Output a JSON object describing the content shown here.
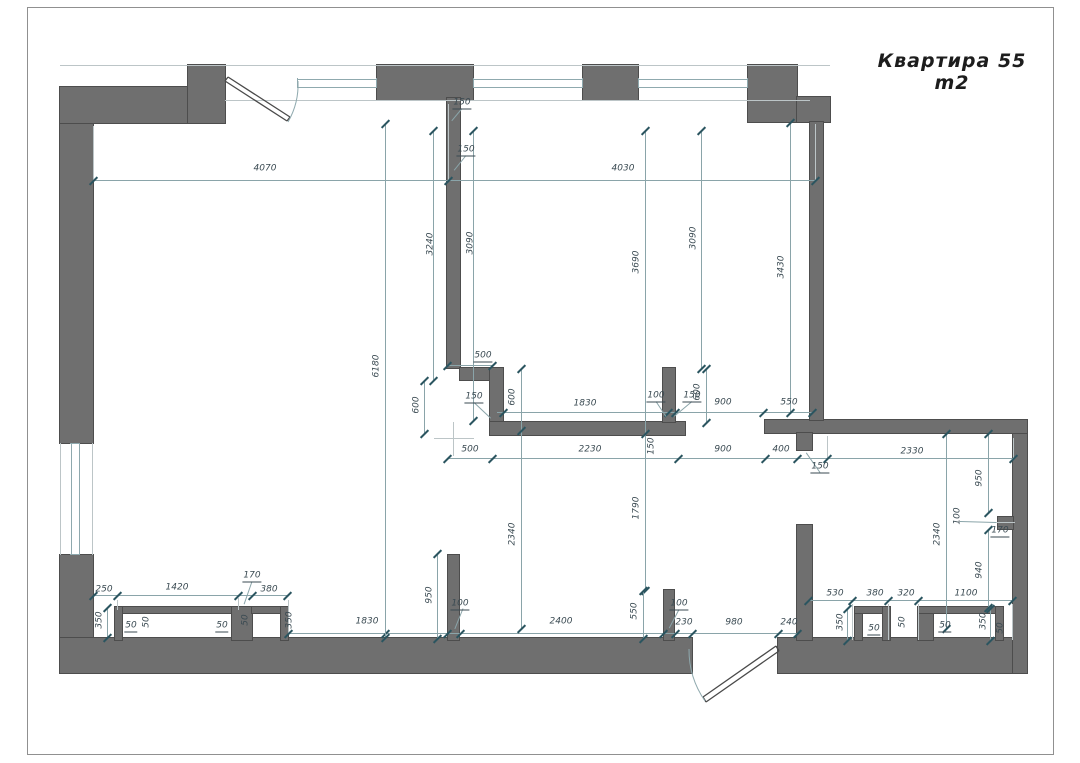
{
  "sheet": {
    "title": "Квартира 55 m2"
  },
  "colors": {
    "wall": "#6f6f6f",
    "walledge": "#4d4d4d",
    "dim": "#8aa4a9",
    "tick": "#2b5560",
    "txt": "#3a4a52",
    "thin": "#bcc5c7",
    "winline": "#8fa9ae",
    "frame": "#909090",
    "door": "#4a4a4a"
  },
  "floorplan": {
    "walls": [
      [
        60,
        87,
        33,
        356
      ],
      [
        60,
        555,
        33,
        85
      ],
      [
        60,
        638,
        632,
        35
      ],
      [
        778,
        638,
        249,
        35
      ],
      [
        1013,
        422,
        14,
        251
      ],
      [
        765,
        420,
        262,
        13
      ],
      [
        60,
        87,
        165,
        36
      ],
      [
        188,
        65,
        37,
        58
      ],
      [
        377,
        65,
        96,
        35
      ],
      [
        583,
        65,
        55,
        35
      ],
      [
        748,
        65,
        49,
        57
      ],
      [
        797,
        97,
        33,
        25
      ],
      [
        810,
        122,
        13,
        298
      ],
      [
        447,
        98,
        13,
        270
      ],
      [
        460,
        368,
        30,
        12
      ],
      [
        490,
        368,
        13,
        54
      ],
      [
        490,
        422,
        195,
        13
      ],
      [
        663,
        368,
        12,
        54
      ],
      [
        797,
        433,
        15,
        17
      ],
      [
        797,
        525,
        15,
        115
      ],
      [
        448,
        555,
        11,
        85
      ],
      [
        664,
        590,
        10,
        50
      ],
      [
        998,
        517,
        15,
        12
      ],
      [
        115,
        607,
        123,
        6
      ],
      [
        115,
        607,
        7,
        33
      ],
      [
        232,
        607,
        20,
        33
      ],
      [
        252,
        607,
        36,
        6
      ],
      [
        281,
        607,
        7,
        33
      ],
      [
        855,
        607,
        7,
        33
      ],
      [
        855,
        607,
        35,
        6
      ],
      [
        883,
        607,
        7,
        33
      ],
      [
        918,
        607,
        15,
        33
      ],
      [
        918,
        607,
        85,
        6
      ],
      [
        996,
        607,
        7,
        33
      ]
    ],
    "windows": [
      {
        "o": "h",
        "x": 297,
        "y": 79,
        "l": 80
      },
      {
        "o": "h",
        "x": 473,
        "y": 79,
        "l": 110
      },
      {
        "o": "h",
        "x": 638,
        "y": 79,
        "l": 110
      },
      {
        "o": "v",
        "x": 71,
        "y": 443,
        "l": 112
      }
    ],
    "thin": [
      [
        "h",
        60,
        65,
        770
      ],
      [
        "h",
        225,
        100,
        585
      ],
      [
        "h",
        434,
        438,
        40
      ],
      [
        "v",
        453,
        422,
        34
      ],
      [
        "v",
        60,
        443,
        112
      ],
      [
        "v",
        92,
        443,
        112
      ]
    ],
    "ext": [
      [
        "v",
        93,
        126,
        56
      ],
      [
        "v",
        448,
        104,
        78
      ],
      [
        "v",
        815,
        124,
        58
      ],
      [
        "v",
        827,
        436,
        24
      ],
      [
        "v",
        1013,
        438,
        22
      ],
      [
        "v",
        288,
        600,
        35
      ],
      [
        "v",
        117,
        600,
        10
      ],
      [
        "v",
        238,
        598,
        12
      ],
      [
        "v",
        852,
        604,
        36
      ],
      [
        "v",
        888,
        604,
        36
      ],
      [
        "v",
        918,
        604,
        36
      ],
      [
        "v",
        1012,
        604,
        36
      ],
      [
        "h",
        995,
        522,
        20
      ]
    ],
    "dim_lines": [
      {
        "o": "h",
        "x": 93,
        "y": 180,
        "l": 722,
        "t": [
          0,
          355,
          722
        ]
      },
      {
        "o": "h",
        "x": 447,
        "y": 365,
        "l": 45,
        "t": [
          0,
          45
        ]
      },
      {
        "o": "h",
        "x": 497,
        "y": 412,
        "l": 315,
        "t": [
          6,
          171,
          178,
          266,
          315
        ]
      },
      {
        "o": "h",
        "x": 447,
        "y": 458,
        "l": 566,
        "t": [
          0,
          45,
          231,
          318,
          350,
          380,
          566
        ]
      },
      {
        "o": "h",
        "x": 93,
        "y": 595,
        "l": 195,
        "t": [
          0,
          24,
          145,
          159,
          194
        ]
      },
      {
        "o": "h",
        "x": 808,
        "y": 600,
        "l": 204,
        "t": [
          0,
          44,
          80,
          110,
          204
        ]
      },
      {
        "o": "h",
        "x": 288,
        "y": 633,
        "l": 509,
        "t": [
          0,
          97,
          159,
          172,
          375,
          387,
          404,
          490,
          509
        ]
      },
      {
        "o": "v",
        "x": 385,
        "y": 123,
        "l": 514,
        "t": [
          0,
          514
        ]
      },
      {
        "o": "v",
        "x": 433,
        "y": 130,
        "l": 250,
        "t": [
          0,
          250
        ]
      },
      {
        "o": "v",
        "x": 473,
        "y": 130,
        "l": 290,
        "t": [
          0,
          290
        ]
      },
      {
        "o": "v",
        "x": 645,
        "y": 130,
        "l": 460,
        "t": [
          0,
          303,
          460
        ]
      },
      {
        "o": "v",
        "x": 701,
        "y": 130,
        "l": 238,
        "t": [
          0,
          238
        ]
      },
      {
        "o": "v",
        "x": 790,
        "y": 122,
        "l": 290,
        "t": [
          0,
          290
        ]
      },
      {
        "o": "v",
        "x": 424,
        "y": 380,
        "l": 53,
        "t": [
          0,
          53
        ]
      },
      {
        "o": "v",
        "x": 521,
        "y": 368,
        "l": 260,
        "t": [
          0,
          62,
          260
        ]
      },
      {
        "o": "v",
        "x": 706,
        "y": 368,
        "l": 54,
        "t": [
          0,
          54
        ]
      },
      {
        "o": "v",
        "x": 946,
        "y": 433,
        "l": 195,
        "t": [
          0,
          195
        ]
      },
      {
        "o": "v",
        "x": 988,
        "y": 433,
        "l": 79,
        "t": [
          0,
          79
        ]
      },
      {
        "o": "v",
        "x": 988,
        "y": 529,
        "l": 78,
        "t": [
          0,
          78
        ]
      },
      {
        "o": "v",
        "x": 437,
        "y": 553,
        "l": 85,
        "t": [
          0,
          85
        ]
      },
      {
        "o": "v",
        "x": 643,
        "y": 590,
        "l": 48,
        "t": [
          0,
          48
        ]
      },
      {
        "o": "v",
        "x": 107,
        "y": 607,
        "l": 30,
        "t": [
          0,
          30
        ]
      },
      {
        "o": "v",
        "x": 847,
        "y": 608,
        "l": 32,
        "t": [
          0,
          32
        ]
      },
      {
        "o": "v",
        "x": 990,
        "y": 608,
        "l": 32,
        "t": [
          0,
          32
        ]
      }
    ],
    "leaders": [
      [
        462,
        108,
        452,
        120
      ],
      [
        466,
        155,
        454,
        170
      ],
      [
        474,
        402,
        491,
        418
      ],
      [
        656,
        401,
        666,
        416
      ],
      [
        692,
        401,
        674,
        416
      ],
      [
        820,
        472,
        806,
        452
      ],
      [
        252,
        581,
        244,
        604
      ],
      [
        463,
        608,
        455,
        628
      ],
      [
        679,
        609,
        669,
        628
      ],
      [
        960,
        521,
        996,
        522
      ]
    ],
    "labels": [
      [
        "4070",
        265,
        169,
        0,
        0
      ],
      [
        "4030",
        623,
        169,
        0,
        0
      ],
      [
        "150",
        462,
        104,
        0,
        1
      ],
      [
        "150",
        466,
        151,
        0,
        1
      ],
      [
        "500",
        483,
        357,
        0,
        1
      ],
      [
        "150",
        474,
        398,
        0,
        1
      ],
      [
        "1830",
        585,
        404,
        0,
        0
      ],
      [
        "100",
        656,
        397,
        0,
        1
      ],
      [
        "150",
        692,
        397,
        0,
        1
      ],
      [
        "900",
        723,
        403,
        0,
        0
      ],
      [
        "550",
        789,
        403,
        0,
        0
      ],
      [
        "500",
        470,
        450,
        0,
        0
      ],
      [
        "2230",
        590,
        450,
        0,
        0
      ],
      [
        "900",
        723,
        450,
        0,
        0
      ],
      [
        "400",
        781,
        450,
        0,
        0
      ],
      [
        "150",
        820,
        468,
        0,
        1
      ],
      [
        "2330",
        912,
        452,
        0,
        0
      ],
      [
        "170",
        1000,
        532,
        0,
        1
      ],
      [
        "250",
        104,
        590,
        0,
        0
      ],
      [
        "1420",
        177,
        588,
        0,
        0
      ],
      [
        "170",
        252,
        577,
        0,
        1
      ],
      [
        "380",
        269,
        590,
        0,
        0
      ],
      [
        "530",
        835,
        594,
        0,
        0
      ],
      [
        "380",
        875,
        594,
        0,
        0
      ],
      [
        "320",
        906,
        594,
        0,
        0
      ],
      [
        "1100",
        966,
        594,
        0,
        0
      ],
      [
        "1830",
        367,
        622,
        0,
        0
      ],
      [
        "100",
        460,
        605,
        0,
        1
      ],
      [
        "2400",
        561,
        622,
        0,
        0
      ],
      [
        "100",
        679,
        605,
        0,
        1
      ],
      [
        "230",
        684,
        623,
        0,
        0
      ],
      [
        "980",
        734,
        623,
        0,
        0
      ],
      [
        "240",
        789,
        623,
        0,
        0
      ],
      [
        "50",
        131,
        627,
        0,
        1
      ],
      [
        "50",
        222,
        627,
        0,
        1
      ],
      [
        "50",
        874,
        630,
        0,
        1
      ],
      [
        "50",
        945,
        627,
        0,
        1
      ],
      [
        "3240",
        431,
        244,
        1,
        0
      ],
      [
        "3090",
        471,
        243,
        1,
        0
      ],
      [
        "6180",
        377,
        366,
        1,
        0
      ],
      [
        "3690",
        637,
        262,
        1,
        0
      ],
      [
        "3090",
        694,
        238,
        1,
        0
      ],
      [
        "3430",
        782,
        267,
        1,
        0
      ],
      [
        "600",
        417,
        405,
        1,
        0
      ],
      [
        "600",
        513,
        397,
        1,
        0
      ],
      [
        "600",
        698,
        392,
        1,
        0
      ],
      [
        "1790",
        637,
        508,
        1,
        0
      ],
      [
        "2340",
        513,
        534,
        1,
        0
      ],
      [
        "2340",
        938,
        534,
        1,
        0
      ],
      [
        "950",
        980,
        478,
        1,
        0
      ],
      [
        "100",
        958,
        516,
        1,
        0
      ],
      [
        "940",
        980,
        570,
        1,
        0
      ],
      [
        "950",
        430,
        595,
        1,
        0
      ],
      [
        "550",
        635,
        611,
        1,
        0
      ],
      [
        "350",
        100,
        620,
        1,
        0
      ],
      [
        "50",
        147,
        622,
        1,
        0
      ],
      [
        "50",
        246,
        620,
        1,
        0
      ],
      [
        "350",
        290,
        620,
        1,
        0
      ],
      [
        "350",
        841,
        622,
        1,
        0
      ],
      [
        "50",
        903,
        622,
        1,
        0
      ],
      [
        "350",
        984,
        621,
        1,
        0
      ],
      [
        "50",
        1001,
        628,
        1,
        0
      ],
      [
        "150",
        652,
        446,
        1,
        0
      ]
    ],
    "door_leafs": [
      "M225 81 L287 121 M228 77 L290 117 M225 81 L228 77 M287 121 L290 117",
      "M779 651 L706 702 M776 646 L703 697 M779 651 L776 646 M706 702 L703 697"
    ],
    "door_arcs": [
      "M288 122 A75 75 0 0 0 298 81",
      "M705 701 A90 90 0 0 1 689 649"
    ]
  }
}
